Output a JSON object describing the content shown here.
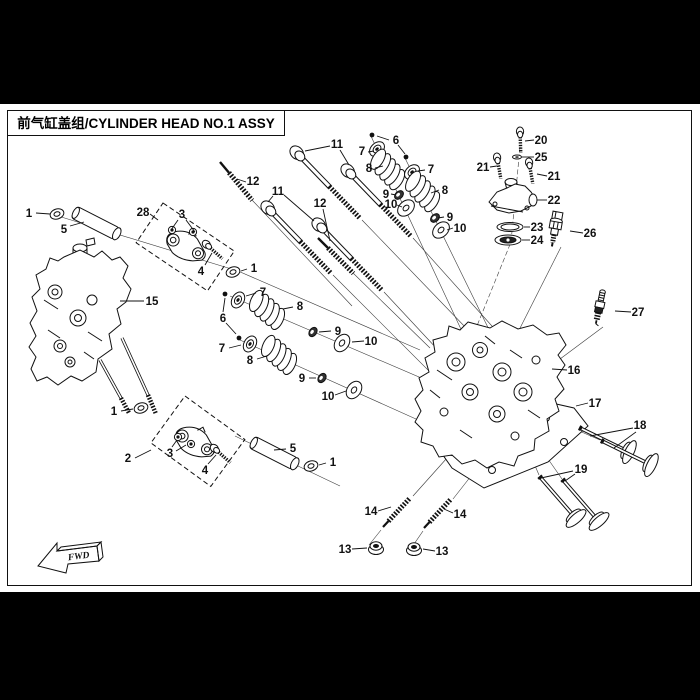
{
  "title_bar": {
    "title": "前气缸盖组/CYLINDER HEAD NO.1 ASSY"
  },
  "fwd_marker": {
    "label": "FWD"
  },
  "colors": {
    "background": "#ffffff",
    "line": "#111111",
    "band": "#000000"
  },
  "diagram": {
    "callouts": [
      {
        "n": "1",
        "x": 29,
        "y": 213,
        "l": [
          [
            36,
            213,
            50,
            214
          ]
        ]
      },
      {
        "n": "5",
        "x": 64,
        "y": 229,
        "l": [
          [
            70,
            226,
            84,
            222
          ]
        ]
      },
      {
        "n": "28",
        "x": 143,
        "y": 212,
        "l": [
          [
            150,
            214,
            158,
            220
          ]
        ]
      },
      {
        "n": "3",
        "x": 182,
        "y": 214,
        "l": [
          [
            178,
            220,
            171,
            230
          ],
          [
            186,
            220,
            195,
            232
          ]
        ]
      },
      {
        "n": "4",
        "x": 201,
        "y": 271,
        "l": [
          [
            205,
            265,
            212,
            253
          ]
        ]
      },
      {
        "n": "15",
        "x": 152,
        "y": 301,
        "l": [
          [
            144,
            301,
            120,
            301
          ]
        ]
      },
      {
        "n": "12",
        "x": 253,
        "y": 181,
        "l": [
          [
            246,
            182,
            237,
            179
          ]
        ]
      },
      {
        "n": "11",
        "x": 337,
        "y": 144,
        "l": [
          [
            330,
            146,
            305,
            151
          ],
          [
            340,
            150,
            349,
            165
          ]
        ]
      },
      {
        "n": "11",
        "x": 278,
        "y": 191,
        "l": [
          [
            273,
            196,
            268,
            202
          ],
          [
            284,
            195,
            314,
            221
          ]
        ]
      },
      {
        "n": "12",
        "x": 320,
        "y": 203,
        "l": [
          [
            323,
            209,
            330,
            241
          ]
        ]
      },
      {
        "n": "6",
        "x": 396,
        "y": 140,
        "l": [
          [
            389,
            140,
            377,
            136
          ],
          [
            398,
            145,
            405,
            154
          ]
        ]
      },
      {
        "n": "7",
        "x": 362,
        "y": 151,
        "l": [
          [
            368,
            152,
            374,
            151
          ]
        ]
      },
      {
        "n": "8",
        "x": 369,
        "y": 168,
        "l": [
          [
            375,
            168,
            383,
            166
          ]
        ]
      },
      {
        "n": "7",
        "x": 431,
        "y": 169,
        "l": [
          [
            425,
            170,
            418,
            171
          ]
        ]
      },
      {
        "n": "8",
        "x": 445,
        "y": 190,
        "l": [
          [
            439,
            190,
            431,
            193
          ]
        ]
      },
      {
        "n": "9",
        "x": 386,
        "y": 194,
        "l": [
          [
            391,
            194,
            396,
            195
          ]
        ]
      },
      {
        "n": "10",
        "x": 391,
        "y": 204,
        "l": [
          [
            397,
            205,
            402,
            207
          ]
        ]
      },
      {
        "n": "9",
        "x": 450,
        "y": 217,
        "l": [
          [
            444,
            217,
            438,
            218
          ]
        ]
      },
      {
        "n": "10",
        "x": 460,
        "y": 228,
        "l": [
          [
            453,
            228,
            447,
            230
          ]
        ]
      },
      {
        "n": "20",
        "x": 541,
        "y": 140,
        "l": [
          [
            534,
            140,
            525,
            141
          ]
        ]
      },
      {
        "n": "25",
        "x": 541,
        "y": 157,
        "l": [
          [
            534,
            157,
            522,
            157
          ]
        ]
      },
      {
        "n": "21",
        "x": 483,
        "y": 167,
        "l": [
          [
            490,
            167,
            497,
            166
          ]
        ]
      },
      {
        "n": "21",
        "x": 554,
        "y": 176,
        "l": [
          [
            547,
            176,
            537,
            174
          ]
        ]
      },
      {
        "n": "22",
        "x": 554,
        "y": 200,
        "l": [
          [
            547,
            200,
            537,
            200
          ]
        ]
      },
      {
        "n": "23",
        "x": 537,
        "y": 227,
        "l": [
          [
            530,
            227,
            524,
            227
          ]
        ]
      },
      {
        "n": "24",
        "x": 537,
        "y": 240,
        "l": [
          [
            530,
            240,
            522,
            240
          ]
        ]
      },
      {
        "n": "26",
        "x": 590,
        "y": 233,
        "l": [
          [
            583,
            233,
            570,
            231
          ]
        ]
      },
      {
        "n": "27",
        "x": 638,
        "y": 312,
        "l": [
          [
            631,
            312,
            615,
            311
          ]
        ]
      },
      {
        "n": "16",
        "x": 574,
        "y": 370,
        "l": [
          [
            567,
            370,
            552,
            369
          ]
        ]
      },
      {
        "n": "17",
        "x": 595,
        "y": 403,
        "l": [
          [
            588,
            403,
            576,
            406
          ]
        ]
      },
      {
        "n": "18",
        "x": 640,
        "y": 425,
        "l": [
          [
            633,
            428,
            590,
            436
          ],
          [
            636,
            432,
            614,
            448
          ]
        ]
      },
      {
        "n": "19",
        "x": 581,
        "y": 469,
        "l": [
          [
            573,
            471,
            541,
            478
          ],
          [
            575,
            474,
            565,
            481
          ]
        ]
      },
      {
        "n": "14",
        "x": 371,
        "y": 511,
        "l": [
          [
            378,
            511,
            391,
            507
          ]
        ]
      },
      {
        "n": "14",
        "x": 460,
        "y": 514,
        "l": [
          [
            453,
            513,
            444,
            509
          ]
        ]
      },
      {
        "n": "13",
        "x": 345,
        "y": 549,
        "l": [
          [
            352,
            549,
            367,
            548
          ]
        ]
      },
      {
        "n": "13",
        "x": 442,
        "y": 551,
        "l": [
          [
            435,
            551,
            423,
            549
          ]
        ]
      },
      {
        "n": "2",
        "x": 128,
        "y": 458,
        "l": [
          [
            135,
            458,
            151,
            450
          ]
        ]
      },
      {
        "n": "3",
        "x": 170,
        "y": 453,
        "l": [
          [
            172,
            447,
            177,
            440
          ],
          [
            176,
            451,
            186,
            445
          ]
        ]
      },
      {
        "n": "4",
        "x": 205,
        "y": 470,
        "l": [
          [
            208,
            464,
            216,
            455
          ]
        ]
      },
      {
        "n": "1",
        "x": 254,
        "y": 268,
        "l": [
          [
            247,
            269,
            241,
            271
          ]
        ]
      },
      {
        "n": "1",
        "x": 114,
        "y": 411,
        "l": [
          [
            121,
            411,
            133,
            409
          ]
        ]
      },
      {
        "n": "1",
        "x": 333,
        "y": 462,
        "l": [
          [
            326,
            463,
            319,
            465
          ]
        ]
      },
      {
        "n": "5",
        "x": 293,
        "y": 448,
        "l": [
          [
            286,
            449,
            274,
            450
          ]
        ]
      },
      {
        "n": "6",
        "x": 223,
        "y": 318,
        "l": [
          [
            223,
            312,
            225,
            298
          ],
          [
            226,
            323,
            236,
            334
          ]
        ]
      },
      {
        "n": "7",
        "x": 263,
        "y": 292,
        "l": [
          [
            256,
            293,
            246,
            296
          ]
        ]
      },
      {
        "n": "8",
        "x": 300,
        "y": 306,
        "l": [
          [
            293,
            307,
            283,
            309
          ]
        ]
      },
      {
        "n": "7",
        "x": 222,
        "y": 348,
        "l": [
          [
            229,
            348,
            241,
            345
          ]
        ]
      },
      {
        "n": "8",
        "x": 250,
        "y": 360,
        "l": [
          [
            257,
            359,
            267,
            356
          ]
        ]
      },
      {
        "n": "9",
        "x": 338,
        "y": 331,
        "l": [
          [
            331,
            331,
            319,
            332
          ]
        ]
      },
      {
        "n": "10",
        "x": 371,
        "y": 341,
        "l": [
          [
            364,
            341,
            352,
            342
          ]
        ]
      },
      {
        "n": "9",
        "x": 302,
        "y": 378,
        "l": [
          [
            309,
            378,
            316,
            378
          ]
        ]
      },
      {
        "n": "10",
        "x": 328,
        "y": 396,
        "l": [
          [
            335,
            395,
            346,
            391
          ]
        ]
      }
    ]
  }
}
